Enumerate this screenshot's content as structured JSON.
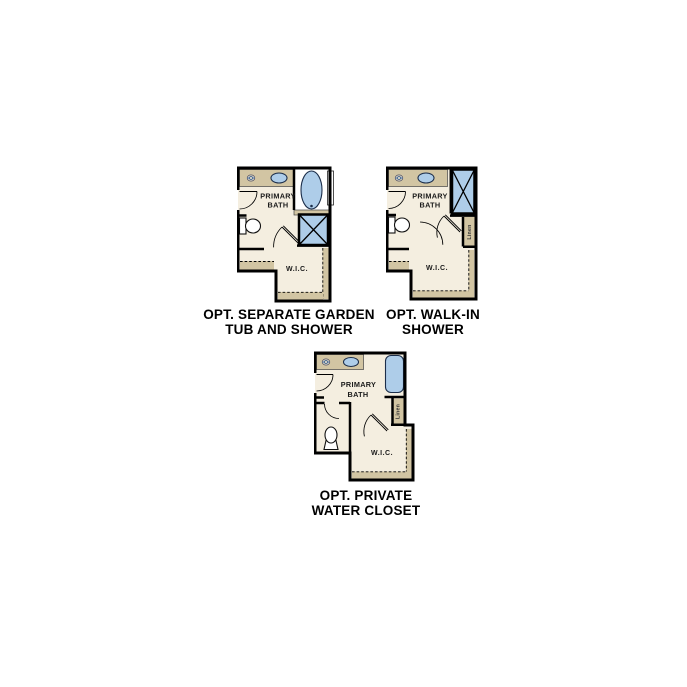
{
  "colors": {
    "background": "#ffffff",
    "floor": "#f4eee0",
    "cabinetry_tan": "#d2c5a3",
    "fixture_blue": "#aecde9",
    "walls": "#000000"
  },
  "plans": [
    {
      "caption_line1": "OPT. SEPARATE GARDEN",
      "caption_line2": "TUB AND SHOWER",
      "room_line1": "PRIMARY",
      "room_line2": "BATH",
      "closet": "W.I.C.",
      "fixtures": [
        "faucet-icon",
        "sink-icon",
        "garden-tub-icon",
        "shower-icon",
        "toilet-icon",
        "window-notch",
        "door-swing-arcs",
        "shelf-and-rod-dashed"
      ]
    },
    {
      "caption_line1": "OPT. WALK-IN",
      "caption_line2": "SHOWER",
      "room_line1": "PRIMARY",
      "room_line2": "BATH",
      "closet": "W.I.C.",
      "linen": "Linen",
      "fixtures": [
        "faucet-icon",
        "sink-icon",
        "walk-in-shower-icon",
        "toilet-icon",
        "door-swing-arcs",
        "shelf-and-rod-dashed"
      ]
    },
    {
      "caption_line1": "OPT. PRIVATE",
      "caption_line2": "WATER CLOSET",
      "room_line1": "PRIMARY",
      "room_line2": "BATH",
      "closet": "W.I.C.",
      "linen": "Linen",
      "fixtures": [
        "faucet-icon",
        "sink-icon",
        "tub-icon",
        "toilet-icon",
        "door-swing-arcs",
        "shelf-and-rod-dashed"
      ]
    }
  ]
}
